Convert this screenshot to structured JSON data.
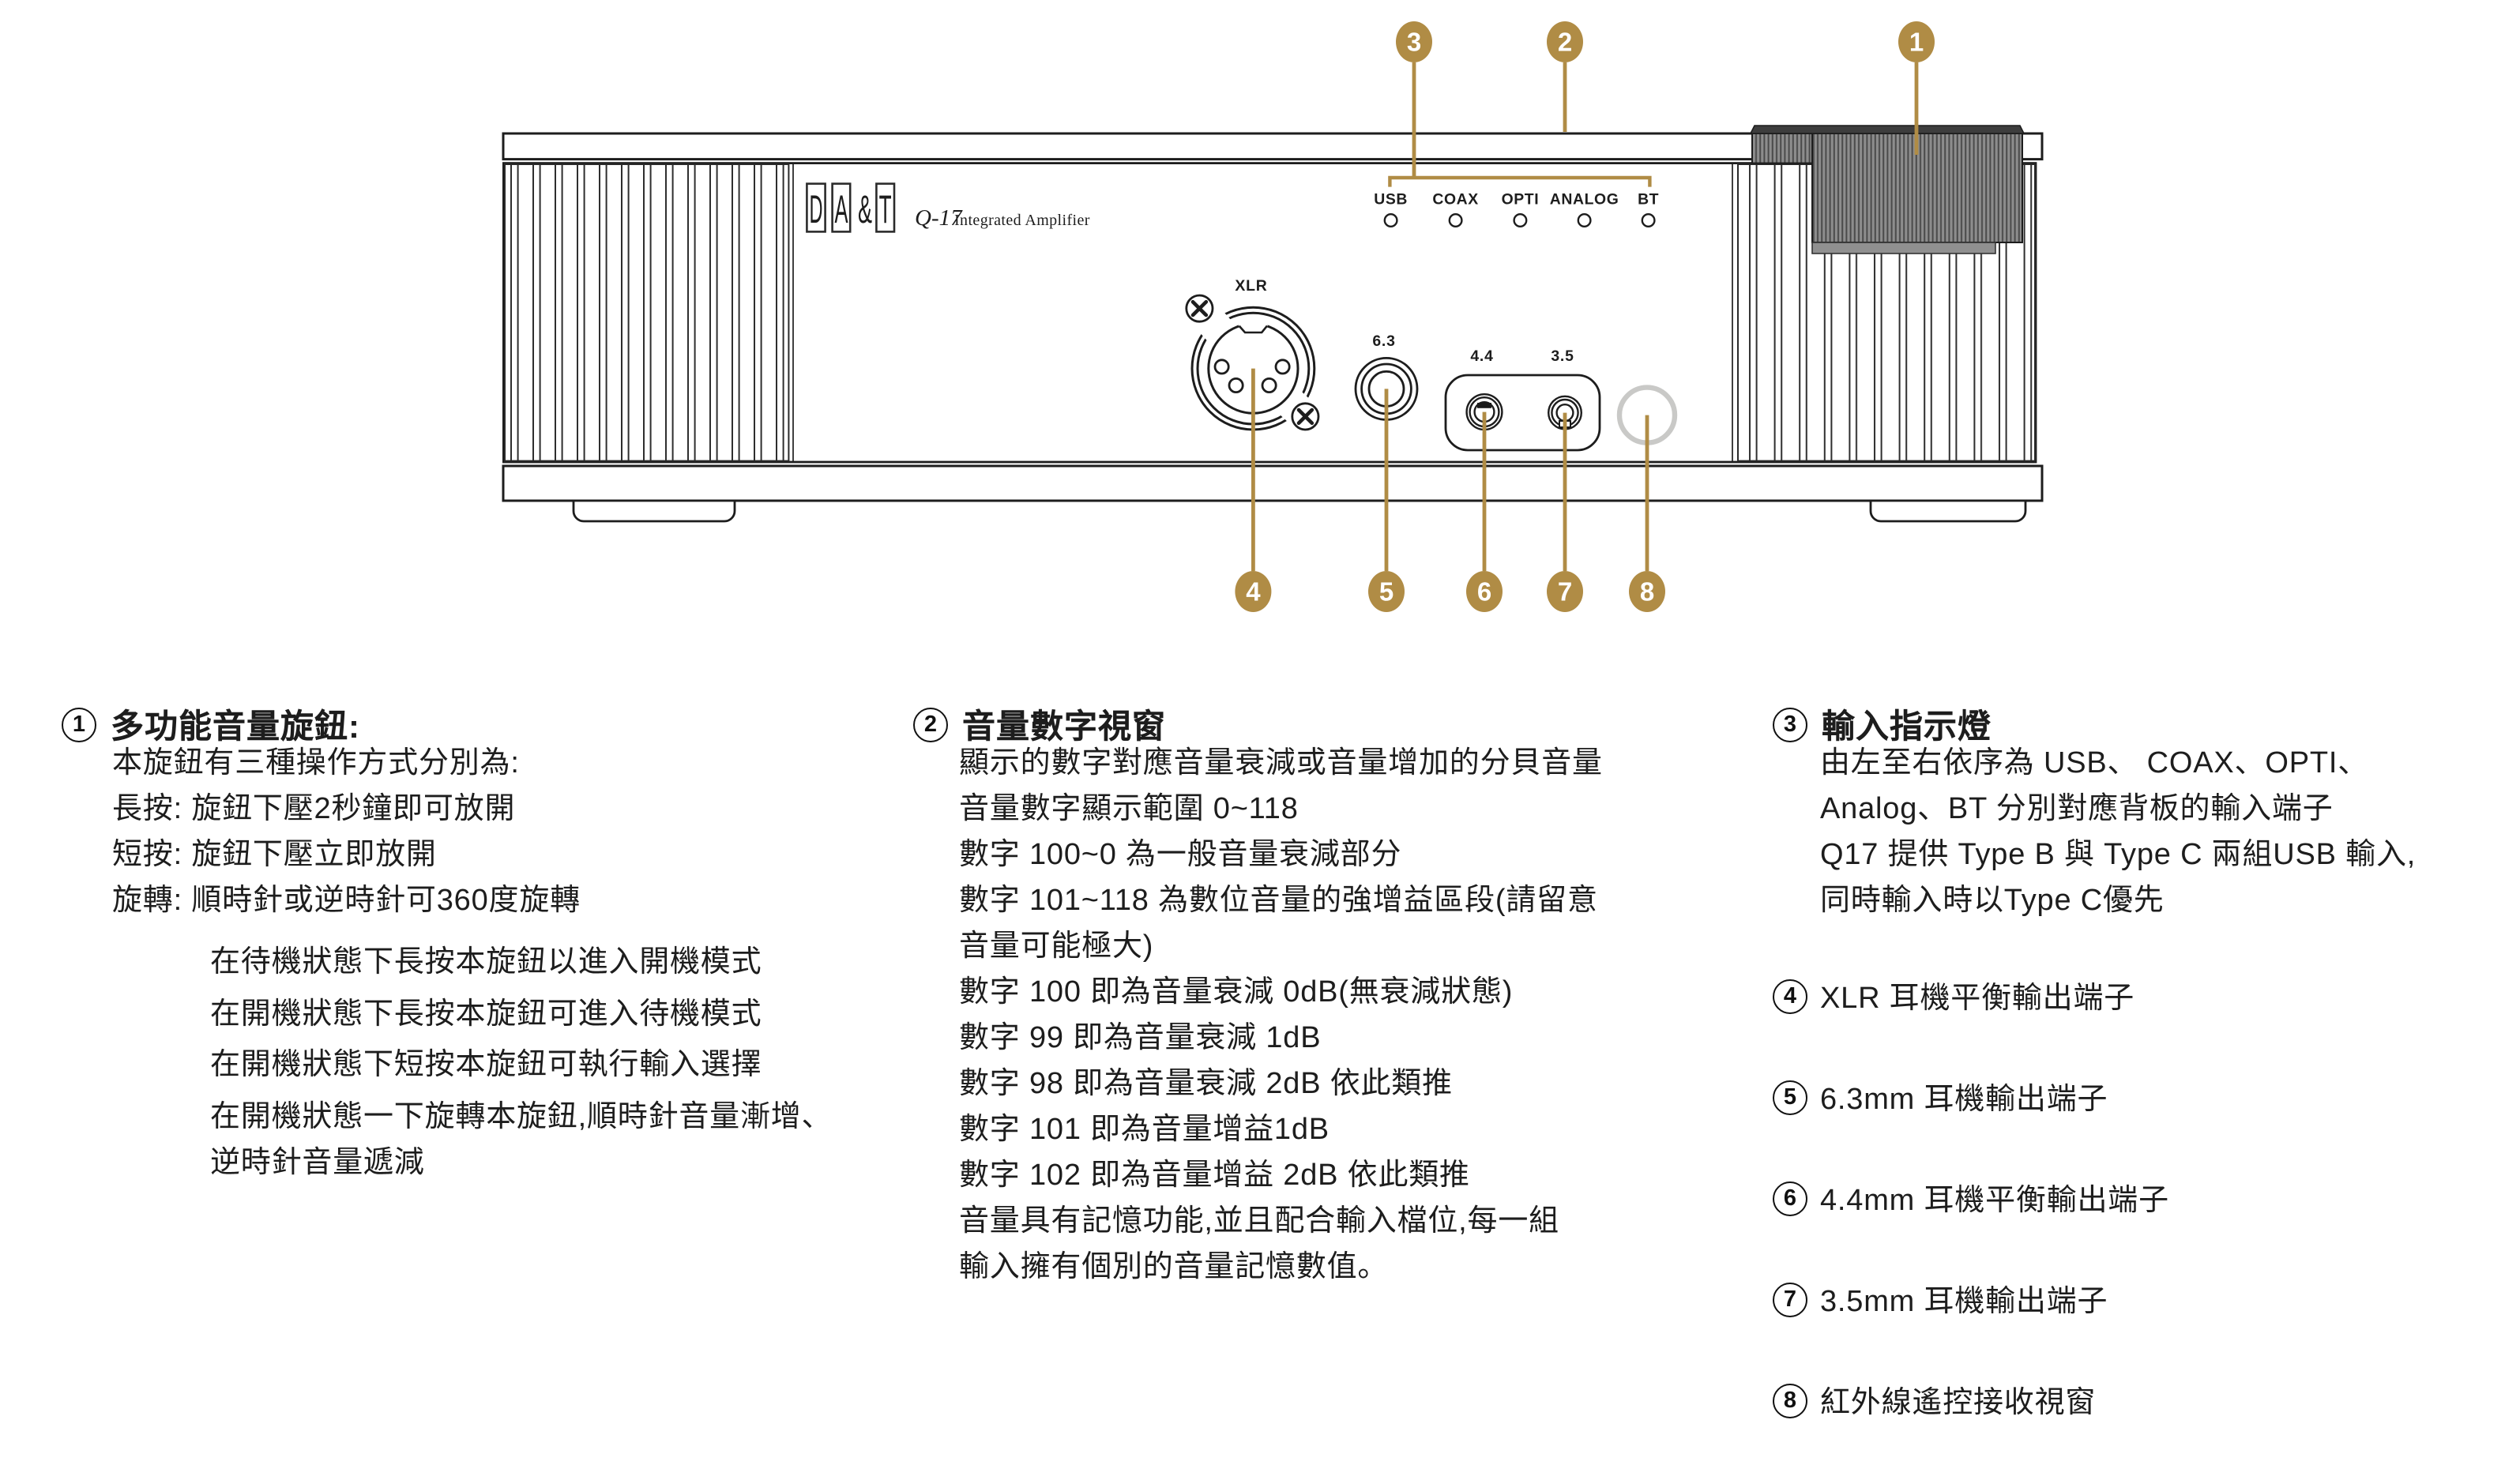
{
  "diagram": {
    "colors": {
      "gold": "#B08C45",
      "ink": "#1D1D1D",
      "knob_base": "#8D8D8D",
      "knob_groove": "#4A4A4A",
      "knob_cap": "#3D3D3D",
      "knob_skirt": "#909090",
      "ir_ring": "#C9C9C7"
    },
    "brand_letters": [
      "D",
      "A",
      "&",
      "T"
    ],
    "model": "Q-17",
    "model_name": "Integrated Amplifier",
    "led_labels": [
      "USB",
      "COAX",
      "OPTI",
      "ANALOG",
      "BT"
    ],
    "jack_labels": {
      "xlr": "XLR",
      "j63": "6.3",
      "j44": "4.4",
      "j35": "3.5"
    },
    "callouts": [
      "1",
      "2",
      "3",
      "4",
      "5",
      "6",
      "7",
      "8"
    ]
  },
  "columns": {
    "c1": {
      "num": "1",
      "title": "多功能音量旋鈕:",
      "lines": [
        "本旋鈕有三種操作方式分別為:",
        "長按: 旋鈕下壓2秒鐘即可放開",
        "短按: 旋鈕下壓立即放開",
        "旋轉: 順時針或逆時針可360度旋轉"
      ],
      "paras": [
        "在待機狀態下長按本旋鈕以進入開機模式",
        "在開機狀態下長按本旋鈕可進入待機模式",
        "在開機狀態下短按本旋鈕可執行輸入選擇",
        "在開機狀態一下旋轉本旋鈕,順時針音量漸增、",
        "逆時針音量遞減"
      ]
    },
    "c2": {
      "num": "2",
      "title": "音量數字視窗",
      "lines": [
        "顯示的數字對應音量衰減或音量增加的分貝音量",
        "音量數字顯示範圍 0~118",
        "數字 100~0 為一般音量衰減部分",
        "數字 101~118 為數位音量的強增益區段(請留意",
        "音量可能極大)",
        "數字 100 即為音量衰減 0dB(無衰減狀態)",
        "數字 99  即為音量衰減 1dB",
        "數字 98  即為音量衰減 2dB  依此類推",
        "數字 101 即為音量增益1dB",
        "數字 102 即為音量增益 2dB 依此類推",
        "音量具有記憶功能,並且配合輸入檔位,每一組",
        "輸入擁有個別的音量記憶數值。"
      ]
    },
    "c3": {
      "num": "3",
      "title": "輸入指示燈",
      "lines": [
        "由左至右依序為 USB、 COAX、OPTI、",
        "Analog、BT 分別對應背板的輸入端子",
        "Q17 提供 Type B 與 Type C 兩組USB 輸入,",
        "同時輸入時以Type C優先"
      ],
      "items": [
        {
          "num": "4",
          "text": "XLR 耳機平衡輸出端子"
        },
        {
          "num": "5",
          "text": "6.3mm 耳機輸出端子"
        },
        {
          "num": "6",
          "text": "4.4mm 耳機平衡輸出端子"
        },
        {
          "num": "7",
          "text": "3.5mm 耳機輸出端子"
        },
        {
          "num": "8",
          "text": "紅外線遙控接收視窗"
        }
      ]
    }
  }
}
